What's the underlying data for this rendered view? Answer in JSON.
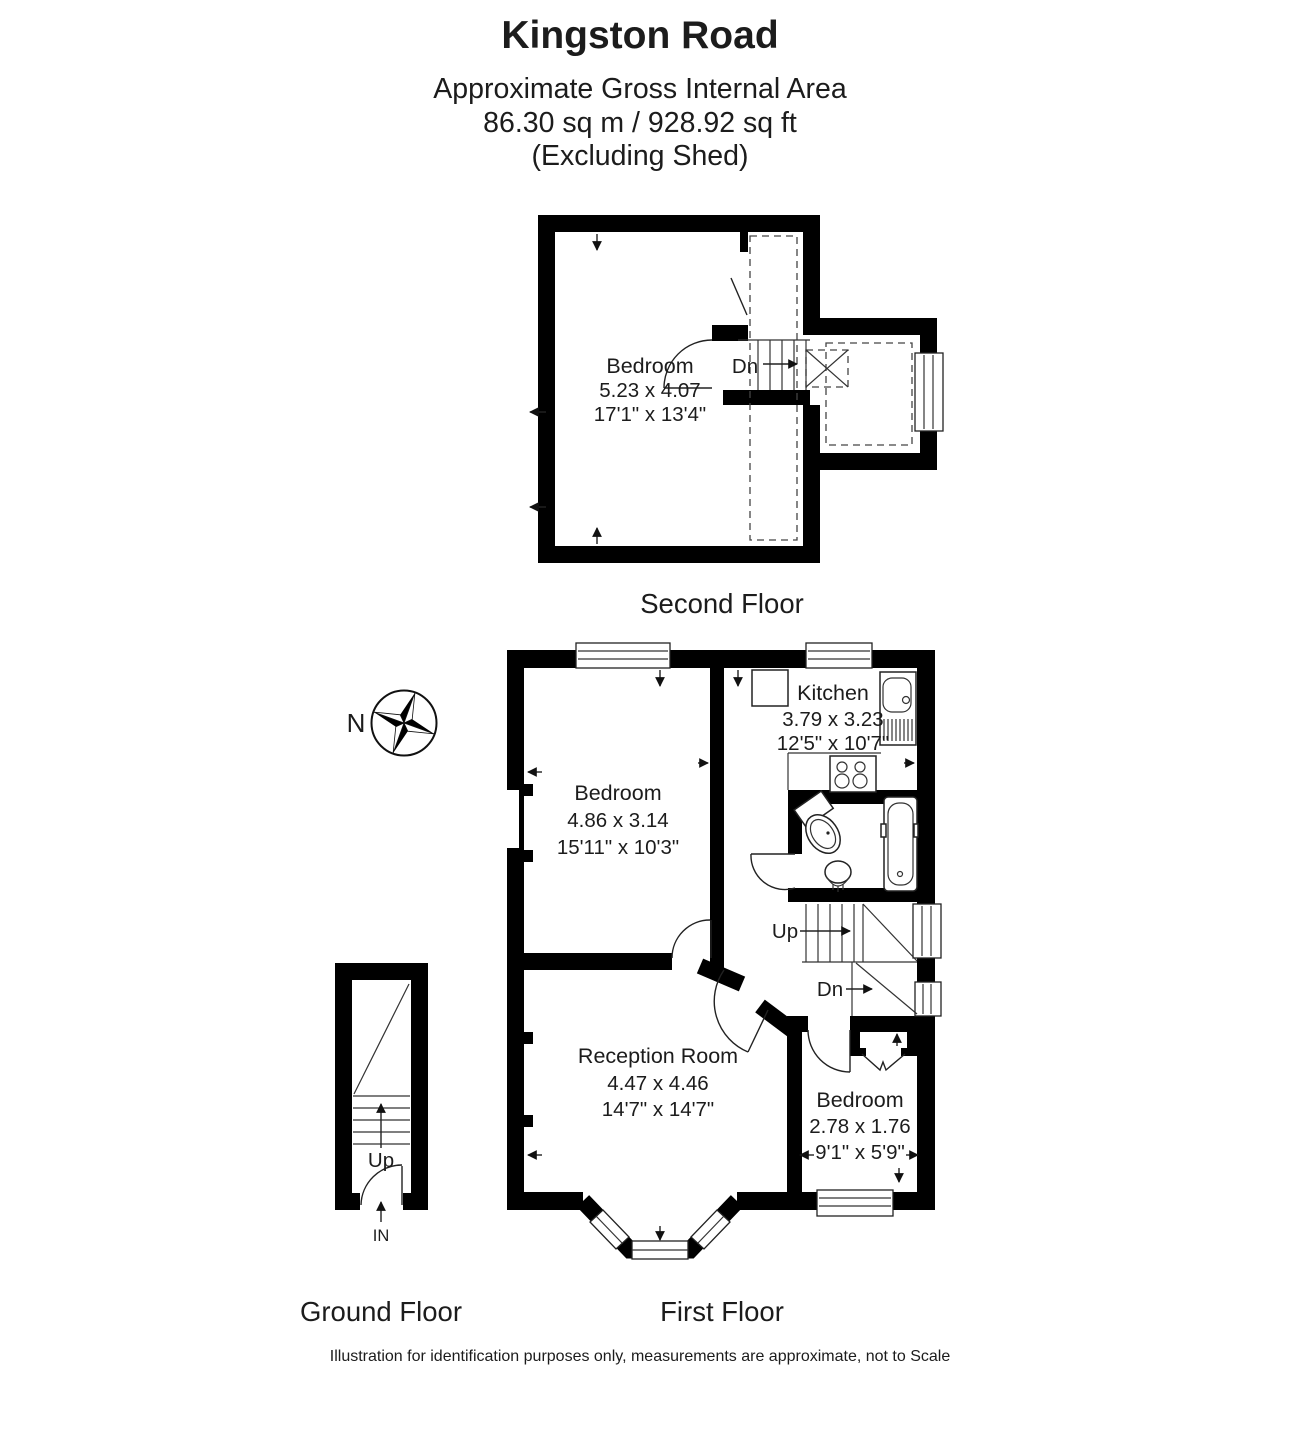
{
  "header": {
    "title": "Kingston Road",
    "subtitle": "Approximate Gross Internal Area",
    "area": "86.30 sq m / 928.92 sq ft",
    "exclusion": "(Excluding Shed)"
  },
  "compass": {
    "north_label": "N"
  },
  "floors": {
    "second": {
      "label": "Second Floor",
      "bedroom": {
        "name": "Bedroom",
        "metric": "5.23 x 4.07",
        "imperial": "17'1\" x 13'4\""
      },
      "stairs_down": "Dn"
    },
    "first": {
      "label": "First Floor",
      "kitchen": {
        "name": "Kitchen",
        "metric": "3.79 x 3.23",
        "imperial": "12'5\" x 10'7\""
      },
      "bedroom1": {
        "name": "Bedroom",
        "metric": "4.86 x 3.14",
        "imperial": "15'11\" x 10'3\""
      },
      "reception": {
        "name": "Reception Room",
        "metric": "4.47 x 4.46",
        "imperial": "14'7\" x 14'7\""
      },
      "bedroom2": {
        "name": "Bedroom",
        "metric": "2.78 x 1.76",
        "imperial": "9'1\" x 5'9\""
      },
      "stairs_up": "Up",
      "stairs_down": "Dn"
    },
    "ground": {
      "label": "Ground Floor",
      "stairs_up": "Up",
      "entrance": "IN"
    }
  },
  "footer": {
    "disclaimer": "Illustration for identification purposes only, measurements are approximate, not to Scale"
  },
  "colors": {
    "wall": "#000000",
    "text": "#1c1c1c",
    "background": "#ffffff"
  }
}
